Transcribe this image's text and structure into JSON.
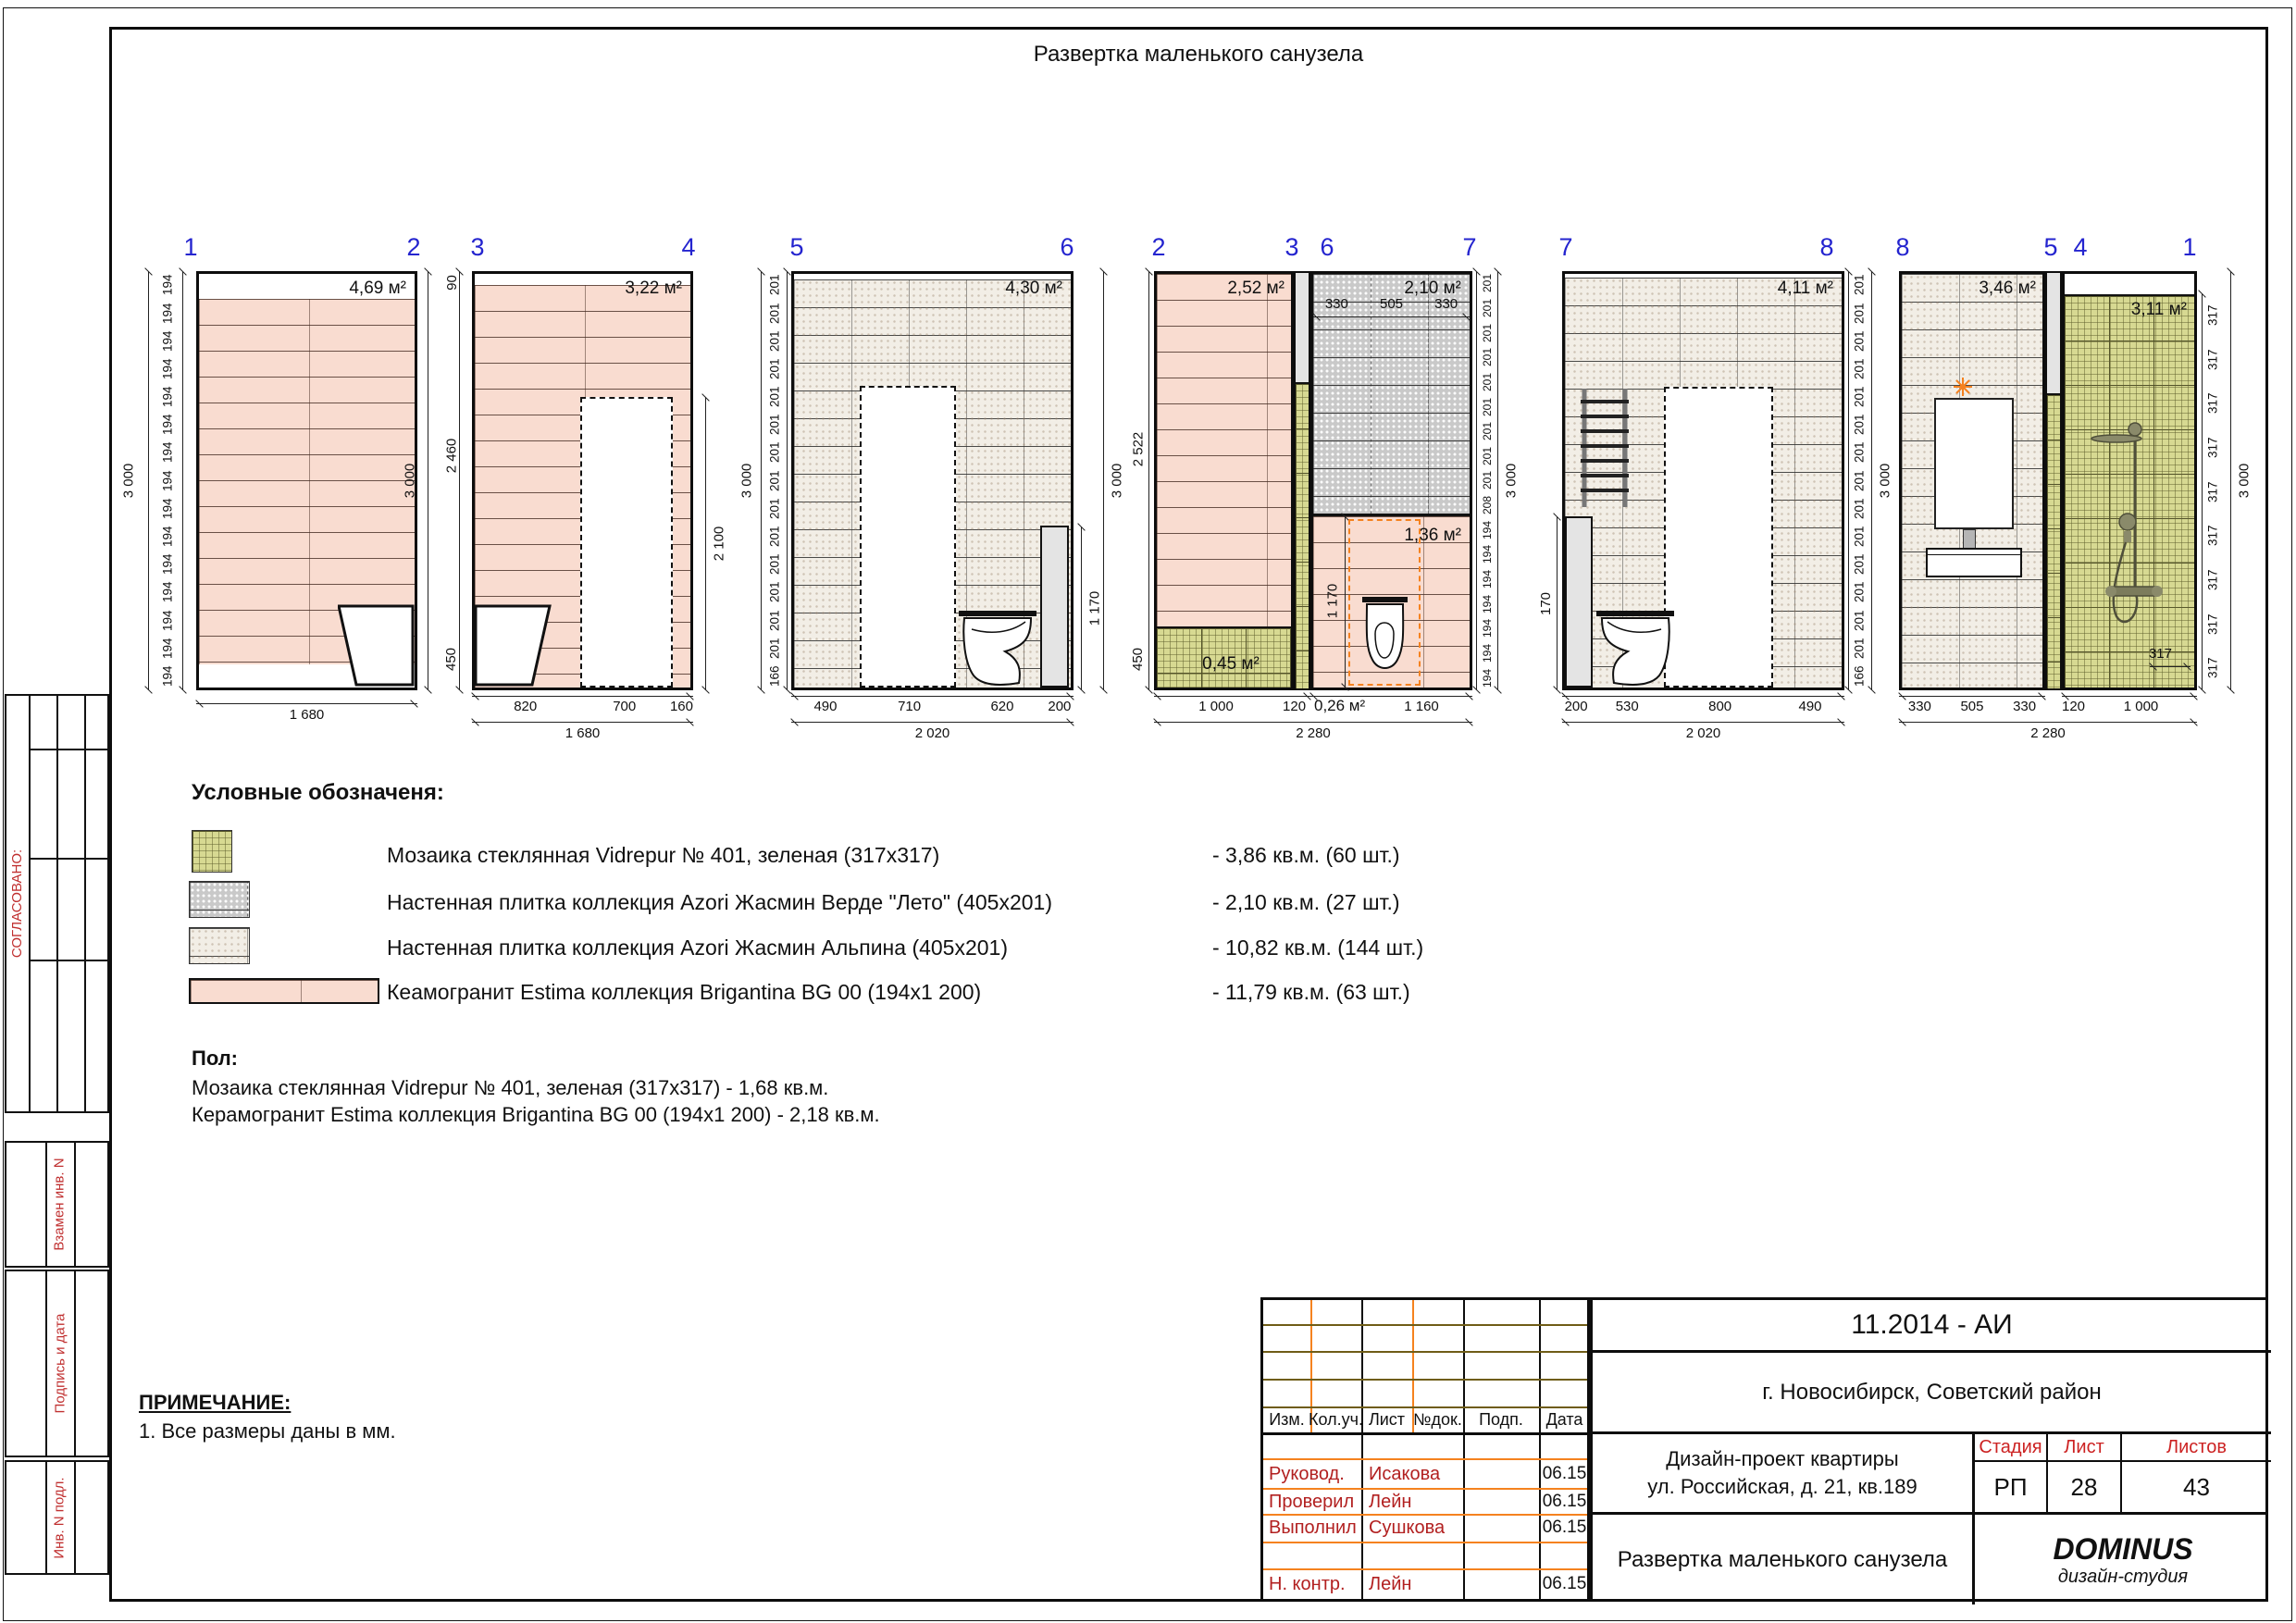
{
  "sheet": {
    "title": "Развертка маленького санузела"
  },
  "panels": {
    "p1": {
      "axes": [
        "1",
        "2"
      ],
      "area": "4,69 м²",
      "side_dims": [
        "194",
        "194",
        "194",
        "194",
        "194",
        "194",
        "194",
        "194",
        "194",
        "194",
        "194",
        "194",
        "194",
        "194",
        "194"
      ],
      "total_h": "3 000",
      "bottom_total": "1 680"
    },
    "p2": {
      "axes": [
        "3",
        "4"
      ],
      "area": "3,22 м²",
      "top_dim": "90",
      "left_dim_mid": "2 460",
      "left_dim_bot": "450",
      "total_h": "3 000",
      "door_dim": "2 100",
      "bottom_segs": [
        "820",
        "700",
        "160"
      ],
      "bottom_total": "1 680"
    },
    "p3": {
      "axes": [
        "5",
        "6"
      ],
      "area": "4,30 м²",
      "side_dims": [
        "201",
        "201",
        "201",
        "201",
        "201",
        "201",
        "201",
        "201",
        "201",
        "201",
        "201",
        "201",
        "201",
        "201",
        "166"
      ],
      "total_h": "3 000",
      "duct_dim": "1 170",
      "bottom_segs": [
        "490",
        "710",
        "620",
        "200"
      ],
      "bottom_total": "2 020"
    },
    "p4": {
      "axes": [
        "2",
        "3",
        "6",
        "7"
      ],
      "area_left": "2,52 м²",
      "area_verde": "2,10 м²",
      "area_peach": "1,36 м²",
      "area_mosaic": "0,45 м²",
      "area_small": "0,26 м²",
      "left_dim_top": "2 522",
      "left_dim_bot": "450",
      "top_segs": [
        "330",
        "505",
        "330"
      ],
      "inner_dim": "1 170",
      "side_dims": [
        "201",
        "201",
        "201",
        "201",
        "201",
        "201",
        "201",
        "201",
        "201",
        "208",
        "194",
        "194",
        "194",
        "194",
        "194",
        "194",
        "194"
      ],
      "total_h": "3 000",
      "bottom_segs_left": [
        "1 000",
        "120"
      ],
      "bottom_seg_right": "1 160",
      "bottom_total": "2 280"
    },
    "p5": {
      "axes": [
        "7",
        "8"
      ],
      "area": "4,11 м²",
      "duct_dim": "170",
      "side_dims": [
        "201",
        "201",
        "201",
        "201",
        "201",
        "201",
        "201",
        "201",
        "201",
        "201",
        "201",
        "201",
        "201",
        "201",
        "166"
      ],
      "total_h": "3 000",
      "bottom_segs": [
        "200",
        "530",
        "800",
        "490"
      ],
      "bottom_total": "2 020"
    },
    "p6": {
      "axes": [
        "8",
        "5",
        "4",
        "1"
      ],
      "area_left": "3,46 м²",
      "area_right": "3,11 м²",
      "tile_dim": "317",
      "side_dims": [
        "317",
        "317",
        "317",
        "317",
        "317",
        "317",
        "317",
        "317",
        "317"
      ],
      "total_h": "3 000",
      "bottom_segs_left": [
        "330",
        "505",
        "330"
      ],
      "bottom_segs_right": [
        "120",
        "1 000"
      ],
      "bottom_total": "2 280"
    }
  },
  "legend": {
    "header": "Условные обозначеня:",
    "items": [
      {
        "label": "Мозаика стеклянная Vidrepur № 401, зеленая (317х317)",
        "qty": "- 3,86 кв.м. (60 шт.)"
      },
      {
        "label": "Настенная плитка коллекция Azori Жасмин Верде \"Лето\" (405х201)",
        "qty": "- 2,10 кв.м. (27 шт.)"
      },
      {
        "label": "Настенная плитка коллекция Azori Жасмин Альпина (405х201)",
        "qty": "- 10,82 кв.м. (144 шт.)"
      },
      {
        "label": "Кеамогранит Estima коллекция Brigantina BG 00 (194х1 200)",
        "qty": "- 11,79 кв.м. (63 шт.)"
      }
    ]
  },
  "floor": {
    "header": "Пол:",
    "lines": [
      "Мозаика стеклянная Vidrepur № 401, зеленая (317х317) - 1,68 кв.м.",
      "Керамогранит Estima коллекция Brigantina BG 00 (194х1 200) - 2,18 кв.м."
    ]
  },
  "note": {
    "header": "ПРИМЕЧАНИЕ:",
    "lines": [
      "1. Все размеры даны в мм."
    ]
  },
  "sidebar": {
    "approved": "СОГЛАСОВАНО:",
    "boxes": [
      "Взамен инв. N",
      "Подпись и дата",
      "Инв. N подл."
    ]
  },
  "titleblock": {
    "doc_code": "11.2014 - АИ",
    "location": "г. Новосибирск, Советский район",
    "header_cols": [
      "Изм.",
      "Кол.уч.",
      "Лист",
      "№док.",
      "Подп.",
      "Дата"
    ],
    "sign_rows": [
      {
        "role": "Руковод.",
        "name": "Исакова",
        "date": "06.15"
      },
      {
        "role": "Проверил",
        "name": "Лейн",
        "date": "06.15"
      },
      {
        "role": "Выполнил",
        "name": "Сушкова",
        "date": "06.15"
      },
      {
        "role": "Н. контр.",
        "name": "Лейн",
        "date": "06.15"
      }
    ],
    "project_lines": [
      "Дизайн-проект квартиры",
      "ул. Российская, д. 21, кв.189"
    ],
    "stage_cols": [
      "Стадия",
      "Лист",
      "Листов"
    ],
    "stage_vals": [
      "РП",
      "28",
      "43"
    ],
    "sheet_name": "Развертка маленького санузела",
    "studio": "DOMINUS",
    "studio_sub": "дизайн-студия"
  },
  "colors": {
    "axis_blue": "#2424cf",
    "stamp_red": "#b22020",
    "orange": "#f5821f",
    "olive": "#6f5d17",
    "estima": "#f9dcd0",
    "alpina": "#f2eee6",
    "verde": "#c9c9c9",
    "mosaic": "#d7d992"
  }
}
